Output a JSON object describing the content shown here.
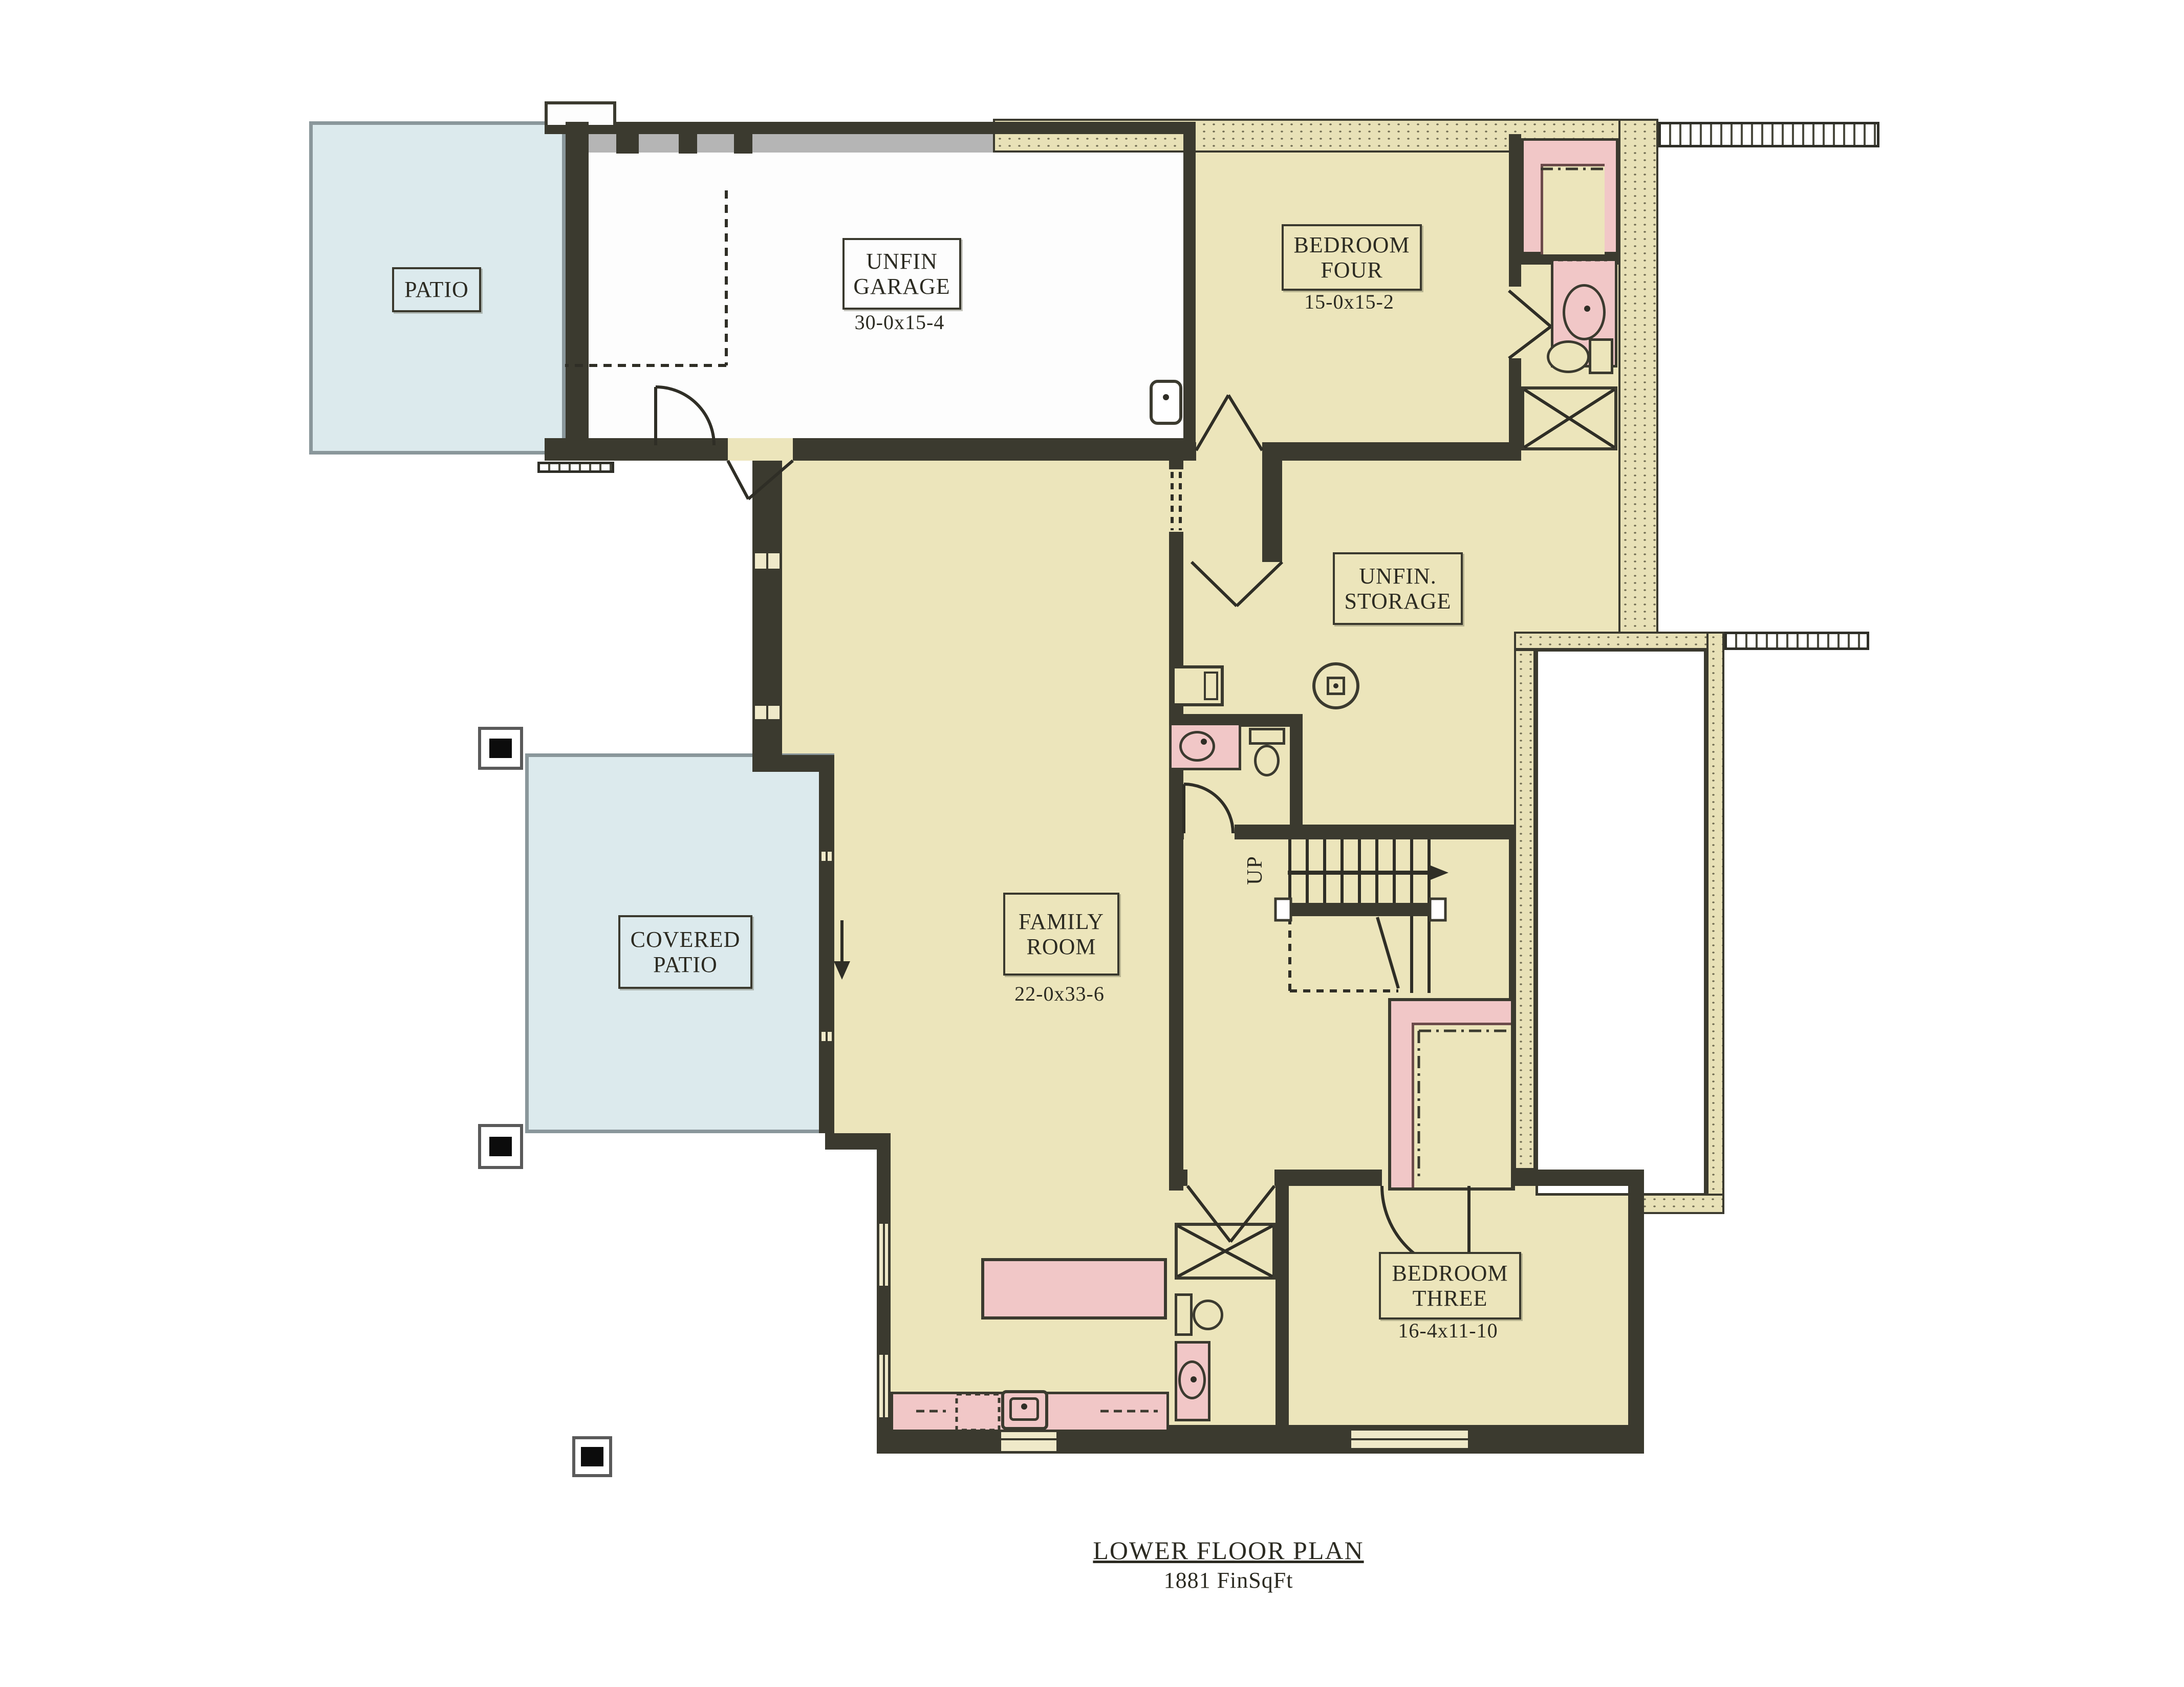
{
  "title": {
    "heading": "LOWER FLOOR PLAN",
    "subheading": "1881 FinSqFt"
  },
  "rooms": {
    "patio": {
      "label": "PATIO"
    },
    "garage": {
      "line1": "UNFIN",
      "line2": "GARAGE",
      "dims": "30-0x15-4"
    },
    "bedroom_four": {
      "line1": "BEDROOM",
      "line2": "FOUR",
      "dims": "15-0x15-2"
    },
    "unfin_storage": {
      "line1": "UNFIN.",
      "line2": "STORAGE"
    },
    "family_room": {
      "line1": "FAMILY",
      "line2": "ROOM",
      "dims": "22-0x33-6"
    },
    "covered_patio": {
      "line1": "COVERED",
      "line2": "PATIO"
    },
    "bedroom_three": {
      "line1": "BEDROOM",
      "line2": "THREE",
      "dims": "16-4x11-10"
    }
  },
  "stairs": {
    "direction_label": "UP"
  },
  "colors": {
    "floor_tan": "#ece5bb",
    "patio_blue": "#dceaed",
    "fixture_pink": "#f1c7c7",
    "wall_dark": "#3b3a2f",
    "foundation_stipple": "#e8e1b7"
  }
}
